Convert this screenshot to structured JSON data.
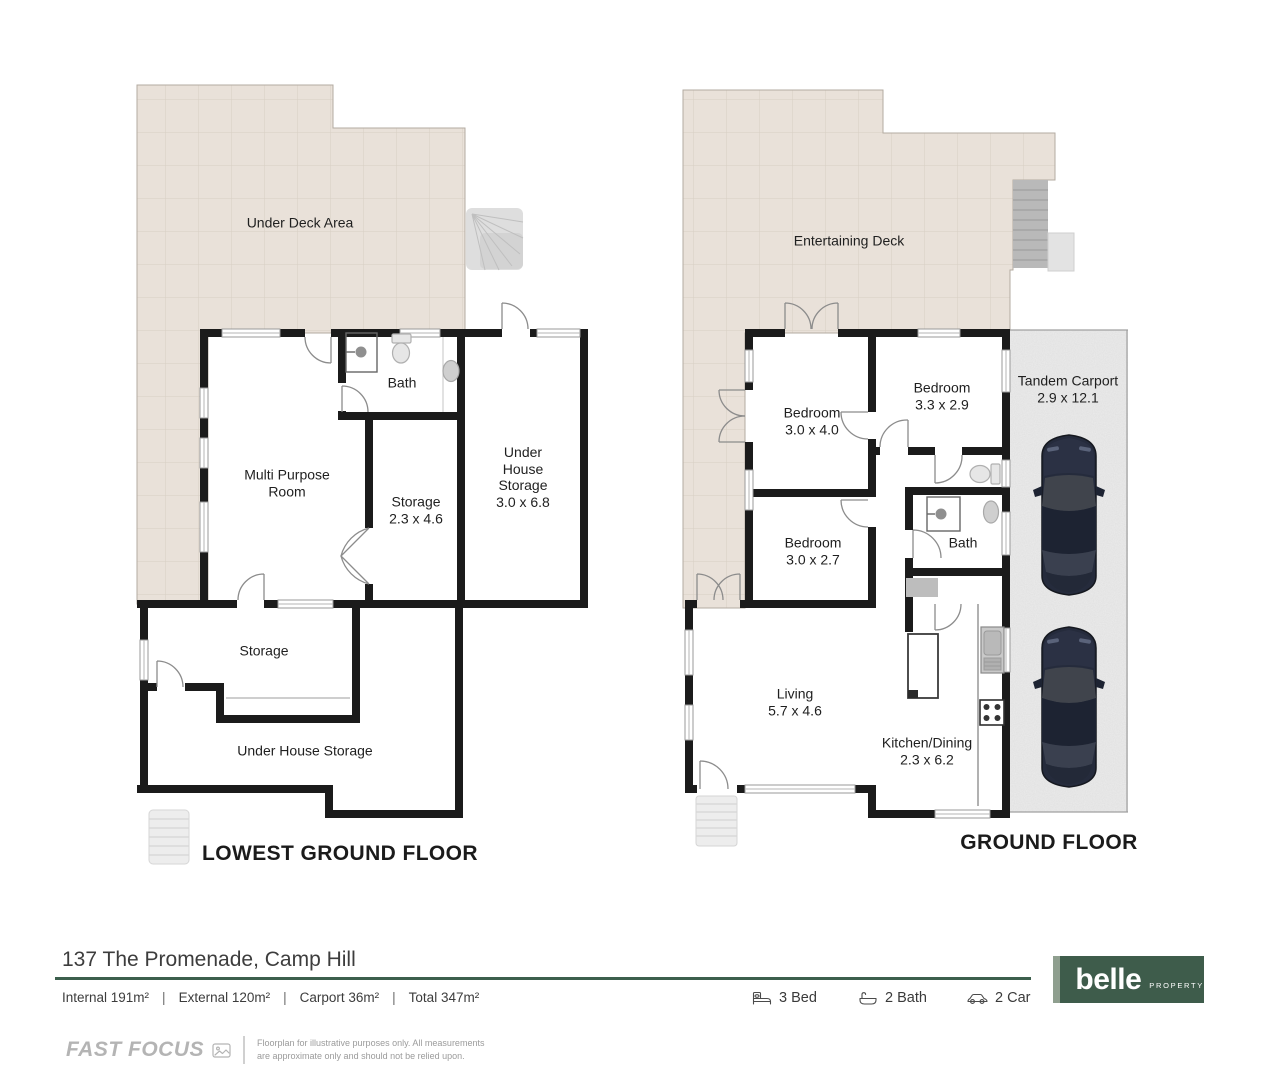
{
  "plans": {
    "lowest": {
      "title": "LOWEST GROUND FLOOR",
      "deck_label": "Under Deck Area",
      "bath": "Bath",
      "multi_purpose": "Multi Purpose Room",
      "storage_upper": {
        "name": "Storage",
        "dim": "2.3 x 4.6"
      },
      "under_house_upper": {
        "name": "Under House Storage",
        "dim": "3.0 x 6.8"
      },
      "storage_lower": "Storage",
      "under_house_lower": "Under House Storage"
    },
    "ground": {
      "title": "GROUND FLOOR",
      "deck_label": "Entertaining Deck",
      "carport": {
        "name": "Tandem Carport",
        "dim": "2.9 x 12.1"
      },
      "bed1": {
        "name": "Bedroom",
        "dim": "3.0 x 4.0"
      },
      "bed2": {
        "name": "Bedroom",
        "dim": "3.3 x 2.9"
      },
      "bed3": {
        "name": "Bedroom",
        "dim": "3.0 x 2.7"
      },
      "bath": "Bath",
      "living": {
        "name": "Living",
        "dim": "5.7 x 4.6"
      },
      "kitchen": {
        "name": "Kitchen/Dining",
        "dim": "2.3 x 6.2"
      }
    }
  },
  "footer": {
    "address": "137 The Promenade, Camp Hill",
    "areas": [
      "Internal 191m²",
      "External 120m²",
      "Carport 36m²",
      "Total 347m²"
    ],
    "separator": "|",
    "features": [
      {
        "icon": "bed-icon",
        "label": "3 Bed"
      },
      {
        "icon": "bath-icon",
        "label": "2 Bath"
      },
      {
        "icon": "car-icon",
        "label": "2 Car"
      }
    ],
    "brand": {
      "name": "belle",
      "tagline": "PROPERTY"
    },
    "credit": {
      "logo": "FAST FOCUS",
      "disclaimer1": "Floorplan for illustrative purposes only. All measurements",
      "disclaimer2": "are approximate only and should not be relied upon."
    }
  },
  "colors": {
    "accent": "#3c5f4d",
    "brand_strip": "#8f9f8f",
    "wall": "#1b1b1b",
    "tile": "#e9e1d9"
  }
}
